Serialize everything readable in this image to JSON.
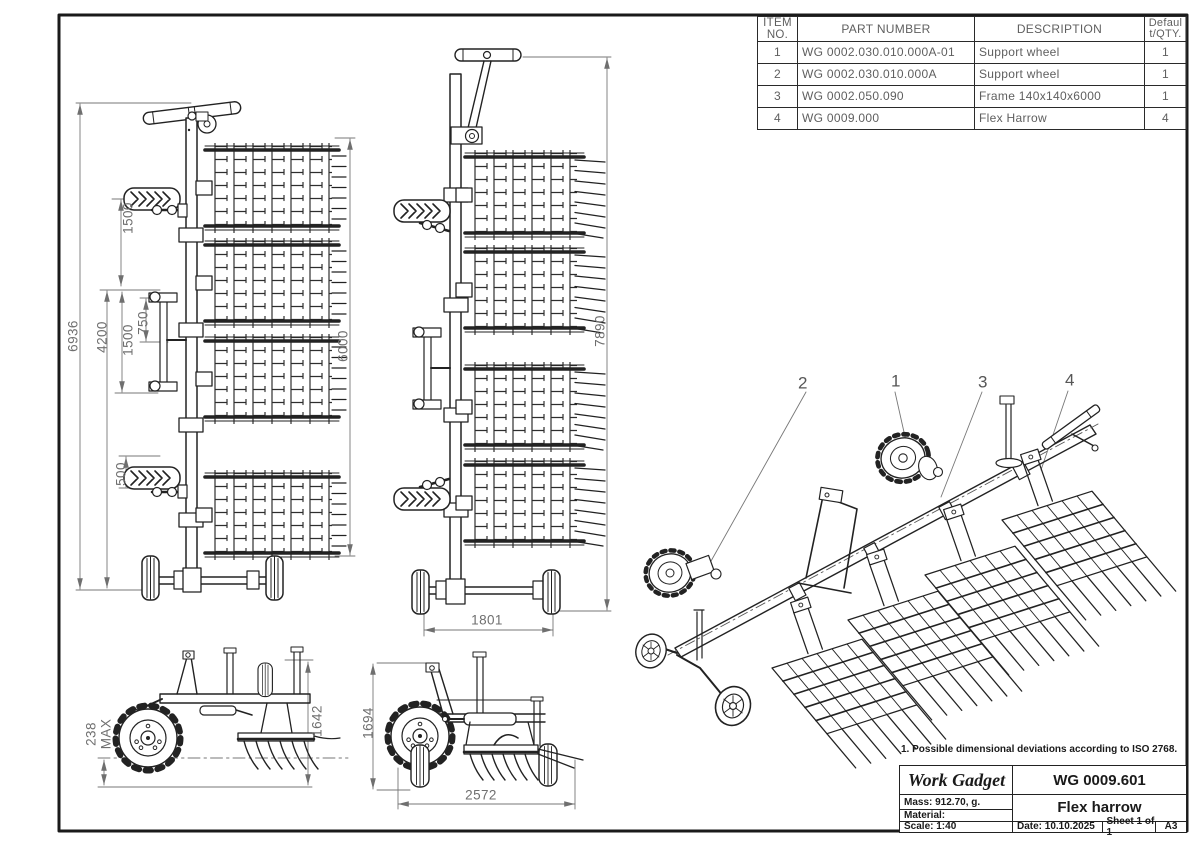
{
  "sheet": {
    "note": "1. Possible dimensional deviations according to ISO 2768.",
    "ink_color": "#222222",
    "dim_text_color": "#6f6f6f"
  },
  "bom": {
    "headers": [
      "ITEM NO.",
      "PART NUMBER",
      "DESCRIPTION",
      "Default/QTY."
    ],
    "rows": [
      [
        "1",
        "WG 0002.030.010.000A-01",
        "Support wheel",
        "1"
      ],
      [
        "2",
        "WG 0002.030.010.000A",
        "Support wheel",
        "1"
      ],
      [
        "3",
        "WG 0002.050.090",
        "Frame 140x140x6000",
        "1"
      ],
      [
        "4",
        "WG 0009.000",
        "Flex Harrow",
        "4"
      ]
    ]
  },
  "dims": {
    "plan_transport": {
      "overall_height": "6936",
      "wheel_to_section": "1500",
      "sections_span": "4200",
      "section_spacing": "1500",
      "linkage": "750",
      "wheel_offset": "500",
      "working_width": "6000"
    },
    "plan_working": {
      "overall_height": "7890",
      "wheel_track": "1801"
    },
    "side_transport": {
      "tine_depth": "238",
      "tine_depth_qualifier": "MAX",
      "height": "1642"
    },
    "side_working": {
      "height": "1694",
      "length": "2572"
    }
  },
  "iso": {
    "balloons": {
      "b1": "1",
      "b2": "2",
      "b3": "3",
      "b4": "4"
    }
  },
  "title_block": {
    "company": "Work Gadget",
    "drawing_number": "WG 0009.601",
    "mass": "Mass: 912.70, g.",
    "material": "Material:",
    "title": "Flex harrow",
    "scale": "Scale: 1:40",
    "date": "Date: 10.10.2025",
    "sheet": "Sheet 1 of 1",
    "format": "A3"
  }
}
